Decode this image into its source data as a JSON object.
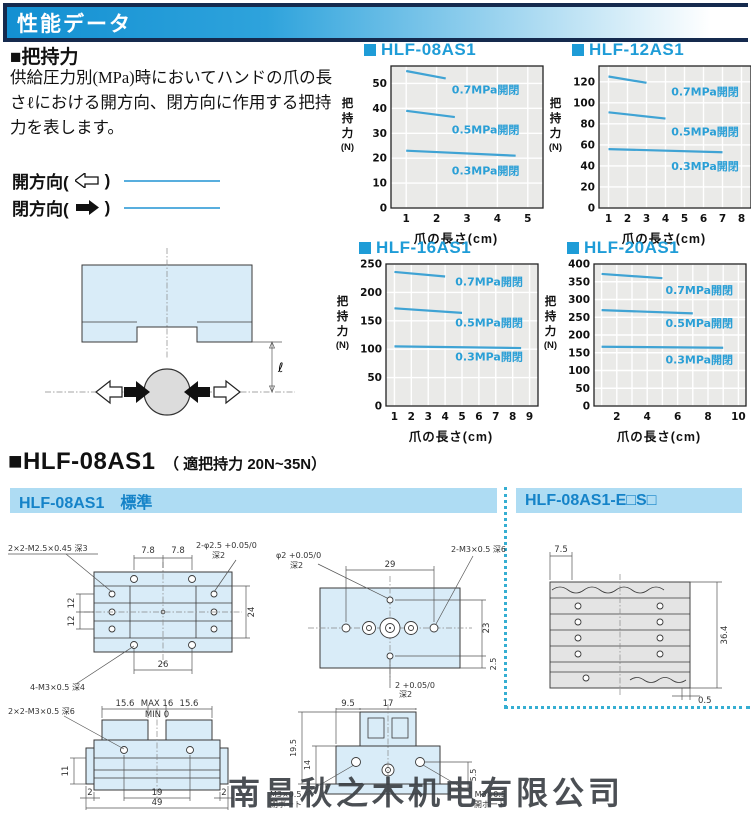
{
  "header": {
    "title": "性能データ"
  },
  "grip": {
    "heading": "■把持力",
    "description": "供給圧力別(MPa)時においてハンドの爪の長さℓにおける開方向、閉方向に作用する把持力を表します。",
    "legend": [
      {
        "prefix": "開方向(",
        "suffix": ")",
        "arrow": "open-left-arrow"
      },
      {
        "prefix": "閉方向(",
        "suffix": ")",
        "arrow": "solid-right-arrow"
      }
    ],
    "dim_label": "ℓ"
  },
  "chart_data": [
    {
      "type": "line",
      "title": "HLF-08AS1",
      "xlabel": "爪の長さ(cm)",
      "ylabel": "把持力(N)",
      "xlim": [
        0.5,
        5.5
      ],
      "ylim": [
        0,
        57
      ],
      "xticks": [
        1,
        2,
        3,
        4,
        5
      ],
      "yticks": [
        0,
        10,
        20,
        30,
        40,
        50
      ],
      "series": [
        {
          "label": "0.7MPa開閉",
          "points": [
            [
              1,
              55
            ],
            [
              2.3,
              52
            ]
          ],
          "label_at": [
            2.5,
            46
          ]
        },
        {
          "label": "0.5MPa開閉",
          "points": [
            [
              1,
              39
            ],
            [
              2.6,
              36.5
            ]
          ],
          "label_at": [
            2.5,
            30
          ]
        },
        {
          "label": "0.3MPa開閉",
          "points": [
            [
              1,
              23
            ],
            [
              4.6,
              21
            ]
          ],
          "label_at": [
            2.5,
            13.5
          ]
        }
      ]
    },
    {
      "type": "line",
      "title": "HLF-12AS1",
      "xlabel": "爪の長さ(cm)",
      "ylabel": "把持力(N)",
      "xlim": [
        0.5,
        8.5
      ],
      "ylim": [
        0,
        135
      ],
      "xticks": [
        1,
        2,
        3,
        4,
        5,
        6,
        7,
        8
      ],
      "yticks": [
        0,
        20,
        40,
        60,
        80,
        100,
        120
      ],
      "series": [
        {
          "label": "0.7MPa開閉",
          "points": [
            [
              1,
              125
            ],
            [
              3,
              119
            ]
          ],
          "label_at": [
            4.3,
            107
          ]
        },
        {
          "label": "0.5MPa開閉",
          "points": [
            [
              1,
              91
            ],
            [
              4,
              85
            ]
          ],
          "label_at": [
            4.3,
            69
          ]
        },
        {
          "label": "0.3MPa開閉",
          "points": [
            [
              1,
              56
            ],
            [
              7,
              53
            ]
          ],
          "label_at": [
            4.3,
            36
          ]
        }
      ]
    },
    {
      "type": "line",
      "title": "HLF-16AS1",
      "xlabel": "爪の長さ(cm)",
      "ylabel": "把持力(N)",
      "xlim": [
        0.5,
        9.5
      ],
      "ylim": [
        0,
        250
      ],
      "xticks": [
        1,
        2,
        3,
        4,
        5,
        6,
        7,
        8,
        9
      ],
      "yticks": [
        0,
        50,
        100,
        150,
        200,
        250
      ],
      "series": [
        {
          "label": "0.7MPa開閉",
          "points": [
            [
              1,
              236
            ],
            [
              4,
              228
            ]
          ],
          "label_at": [
            4.6,
            212
          ]
        },
        {
          "label": "0.5MPa開閉",
          "points": [
            [
              1,
              172
            ],
            [
              5,
              164
            ]
          ],
          "label_at": [
            4.6,
            140
          ]
        },
        {
          "label": "0.3MPa開閉",
          "points": [
            [
              1,
              105
            ],
            [
              8.5,
              102
            ]
          ],
          "label_at": [
            4.6,
            80
          ]
        }
      ]
    },
    {
      "type": "line",
      "title": "HLF-20AS1",
      "xlabel": "爪の長さ(cm)",
      "ylabel": "把持力(N)",
      "xlim": [
        0.5,
        10.5
      ],
      "ylim": [
        0,
        400
      ],
      "xticks": [
        2,
        4,
        6,
        8,
        10
      ],
      "yticks": [
        0,
        50,
        100,
        150,
        200,
        250,
        300,
        350,
        400
      ],
      "series": [
        {
          "label": "0.7MPa開閉",
          "points": [
            [
              1,
              372
            ],
            [
              5,
              360
            ]
          ],
          "label_at": [
            5.2,
            315
          ]
        },
        {
          "label": "0.5MPa開閉",
          "points": [
            [
              1,
              270
            ],
            [
              7,
              261
            ]
          ],
          "label_at": [
            5.2,
            222
          ]
        },
        {
          "label": "0.3MPa開閉",
          "points": [
            [
              1,
              167
            ],
            [
              9,
              164
            ]
          ],
          "label_at": [
            5.2,
            120
          ]
        }
      ]
    }
  ],
  "model_section": {
    "title": "■HLF-08AS1",
    "subtitle": "（ 適把持力 20N~35N）",
    "standard_header": "HLF-08AS1　標準",
    "option_header": "HLF-08AS1-E□S□"
  },
  "drawings": {
    "top_view": {
      "dim_78a": "7.8",
      "dim_78b": "7.8",
      "dim_12a": "12",
      "dim_12b": "12",
      "dim_24": "24",
      "dim_26": "26",
      "label_tap": "2×2-M2.5×0.45 深3",
      "label_holes_1": "2-φ2.5 +0.05/0",
      "label_holes_2": "深2",
      "label_bottom_tap": "4-M3×0.5 深4"
    },
    "front_view": {
      "label_tap": "2×2-M3×0.5 深6",
      "dim_156a": "15.6",
      "dim_max": "MAX 16",
      "dim_156b": "15.6",
      "dim_min": "MIN 0",
      "dim_11": "11",
      "dim_2a": "2",
      "dim_19": "19",
      "dim_2b": "2",
      "dim_49": "49"
    },
    "bottom_view": {
      "label_hole_top_1": "φ2 +0.05/0",
      "label_hole_top_2": "深2",
      "dim_29": "29",
      "label_tap": "2-M3×0.5 深6",
      "dim_23": "23",
      "dim_25": "2.5",
      "label_hole_bottom_1": "2 +0.05/0",
      "label_hole_bottom_2": "深2"
    },
    "side_view": {
      "dim_95": "9.5",
      "dim_17": "17",
      "dim_195": "19.5",
      "dim_14": "14",
      "dim_55": "5.5",
      "port_close_1": "M3×0.5",
      "port_close_2": "閉ポート",
      "port_open_1": "M3×0.5",
      "port_open_2": "開ポート"
    },
    "option_view": {
      "dim_75": "7.5",
      "dim_364": "36.4",
      "dim_05": "0.5"
    }
  },
  "watermark": "南昌秋之木机电有限公司",
  "colors": {
    "accent_blue": "#1e9cd7",
    "series_line": "#3fa3d4",
    "series_label": "#2a9fd6",
    "bar_bg": "#aedcf3",
    "bar_text": "#1583c8",
    "header_navy": "#152a4e",
    "plot_bg": "#eaeae8",
    "drawing_fill": "#d9ecf8",
    "dotted": "#35aed2"
  }
}
